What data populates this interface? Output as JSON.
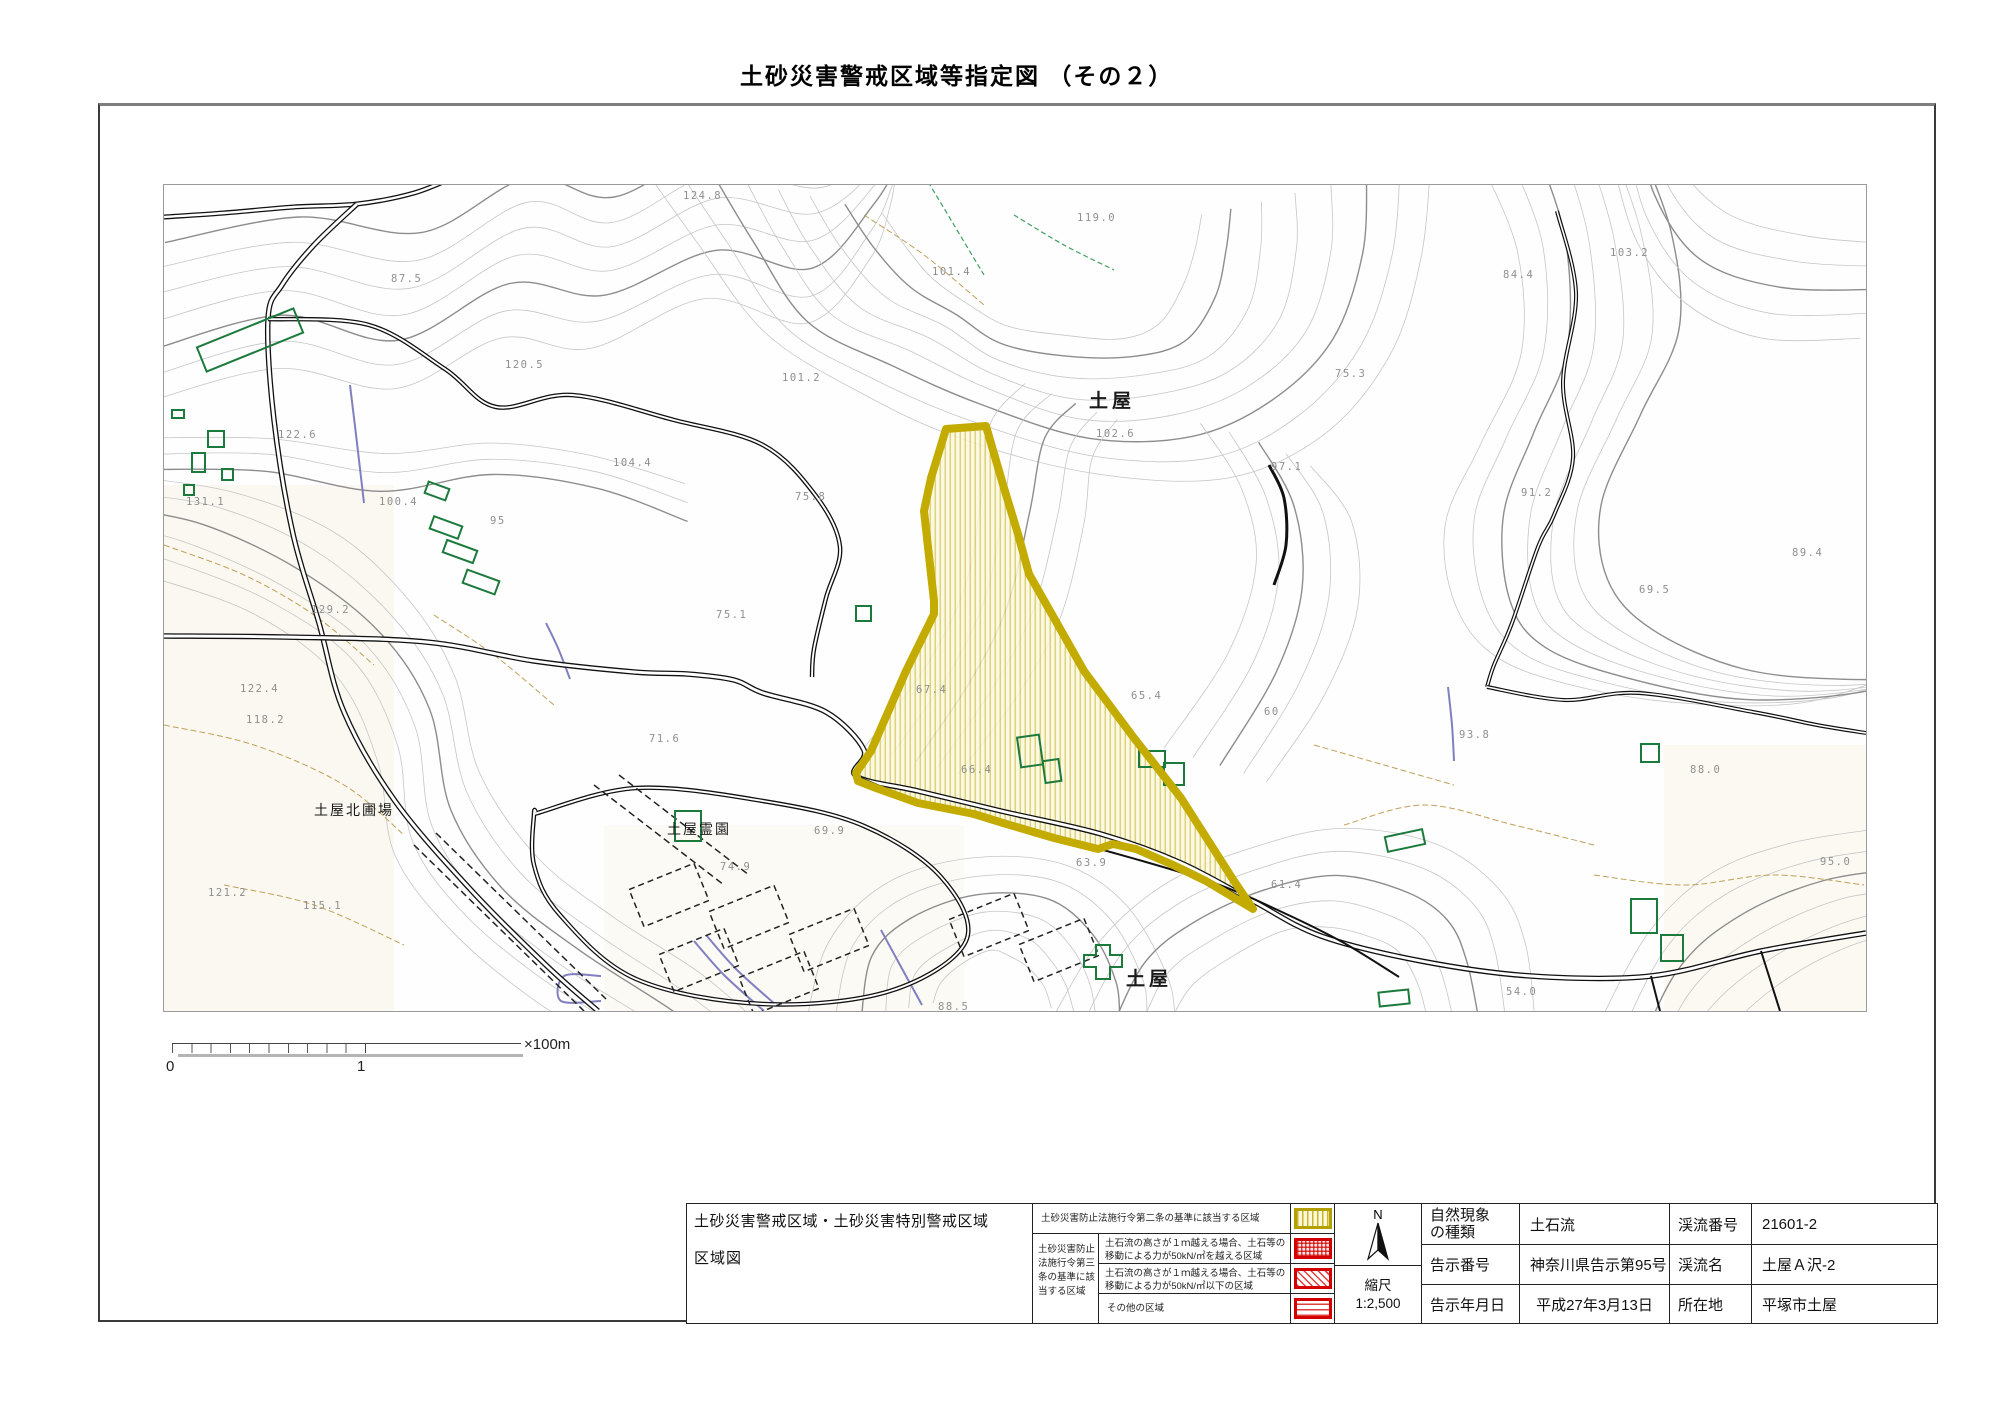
{
  "title": "土砂災害警戒区域等指定図 （その２）",
  "map": {
    "area_labels": [
      {
        "text": "土屋",
        "x": 925,
        "y": 222,
        "cls": "district"
      },
      {
        "text": "土屋",
        "x": 962,
        "y": 800,
        "cls": "district"
      },
      {
        "text": "土屋北圃場",
        "x": 150,
        "y": 630,
        "cls": "place"
      },
      {
        "text": "土屋霊園",
        "x": 503,
        "y": 649,
        "cls": "place"
      }
    ],
    "elevations": [
      {
        "v": "124.8",
        "x": 519,
        "y": 14
      },
      {
        "v": "119.0",
        "x": 913,
        "y": 36
      },
      {
        "v": "101.4",
        "x": 768,
        "y": 90
      },
      {
        "v": "84.4",
        "x": 1339,
        "y": 93
      },
      {
        "v": "103.2",
        "x": 1446,
        "y": 71
      },
      {
        "v": "87.5",
        "x": 227,
        "y": 97
      },
      {
        "v": "101.2",
        "x": 618,
        "y": 196
      },
      {
        "v": "75.3",
        "x": 1171,
        "y": 192
      },
      {
        "v": "120.5",
        "x": 341,
        "y": 183
      },
      {
        "v": "102.6",
        "x": 932,
        "y": 252
      },
      {
        "v": "122.6",
        "x": 114,
        "y": 253
      },
      {
        "v": "97.1",
        "x": 1107,
        "y": 285
      },
      {
        "v": "91.2",
        "x": 1357,
        "y": 311
      },
      {
        "v": "104.4",
        "x": 449,
        "y": 281
      },
      {
        "v": "75.8",
        "x": 631,
        "y": 315
      },
      {
        "v": "95",
        "x": 326,
        "y": 339
      },
      {
        "v": "100.4",
        "x": 215,
        "y": 320
      },
      {
        "v": "131.1",
        "x": 22,
        "y": 320
      },
      {
        "v": "89.4",
        "x": 1628,
        "y": 371
      },
      {
        "v": "69.5",
        "x": 1475,
        "y": 408
      },
      {
        "v": "75.1",
        "x": 552,
        "y": 433
      },
      {
        "v": "129.2",
        "x": 147,
        "y": 428
      },
      {
        "v": "122.4",
        "x": 76,
        "y": 507
      },
      {
        "v": "118.2",
        "x": 82,
        "y": 538
      },
      {
        "v": "67.4",
        "x": 752,
        "y": 508
      },
      {
        "v": "65.4",
        "x": 967,
        "y": 514
      },
      {
        "v": "60",
        "x": 1100,
        "y": 530
      },
      {
        "v": "93.8",
        "x": 1295,
        "y": 553
      },
      {
        "v": "71.6",
        "x": 485,
        "y": 557
      },
      {
        "v": "88.0",
        "x": 1526,
        "y": 588
      },
      {
        "v": "95.0",
        "x": 1656,
        "y": 680
      },
      {
        "v": "74.9",
        "x": 556,
        "y": 685
      },
      {
        "v": "66.4",
        "x": 797,
        "y": 588
      },
      {
        "v": "63.9",
        "x": 912,
        "y": 681
      },
      {
        "v": "61.4",
        "x": 1107,
        "y": 703
      },
      {
        "v": "121.2",
        "x": 44,
        "y": 711
      },
      {
        "v": "115.1",
        "x": 139,
        "y": 724
      },
      {
        "v": "54.0",
        "x": 1342,
        "y": 810
      },
      {
        "v": "88.5",
        "x": 774,
        "y": 825
      },
      {
        "v": "69.9",
        "x": 650,
        "y": 649
      }
    ]
  },
  "scale_bar": {
    "zero": "0",
    "one": "1",
    "unit": "×100m"
  },
  "legend": {
    "title_line1": "土砂災害警戒区域・土砂災害特別警戒区域",
    "title_line2": "区域図",
    "row1": "土砂災害防止法施行令第二条の基準に該当する区域",
    "group_lines": [
      "土砂災害防止",
      "法施行令第三",
      "条の基準に該",
      "当する区域"
    ],
    "row2_line1": "土石流の高さが１ｍ越える場合、土石等の",
    "row2_line2": "移動による力が50kN/㎡を越える区域",
    "row3_line1": "土石流の高さが１ｍ越える場合、土石等の",
    "row3_line2": "移動による力が50kN/㎡以下の区域",
    "row4": "その他の区域"
  },
  "compass": {
    "label": "N"
  },
  "scale": {
    "label": "縮尺",
    "value": "1:2,500"
  },
  "info": {
    "nature_label_1": "自然現象",
    "nature_label_2": "の種類",
    "nature_value": "土石流",
    "notice_no_label": "告示番号",
    "notice_no_value": "神奈川県告示第95号",
    "notice_date_label": "告示年月日",
    "notice_date_value": "平成27年3月13日",
    "stream_no_label": "渓流番号",
    "stream_no_value": "21601-2",
    "stream_name_label": "渓流名",
    "stream_name_value": "土屋Ａ沢-2",
    "location_label": "所在地",
    "location_value": "平塚市土屋"
  },
  "colors": {
    "hazard_yellow": "#c3ab00",
    "hazard_red": "#d40000",
    "building_green": "#1c7a3c",
    "stream_blue": "#8080c0"
  }
}
